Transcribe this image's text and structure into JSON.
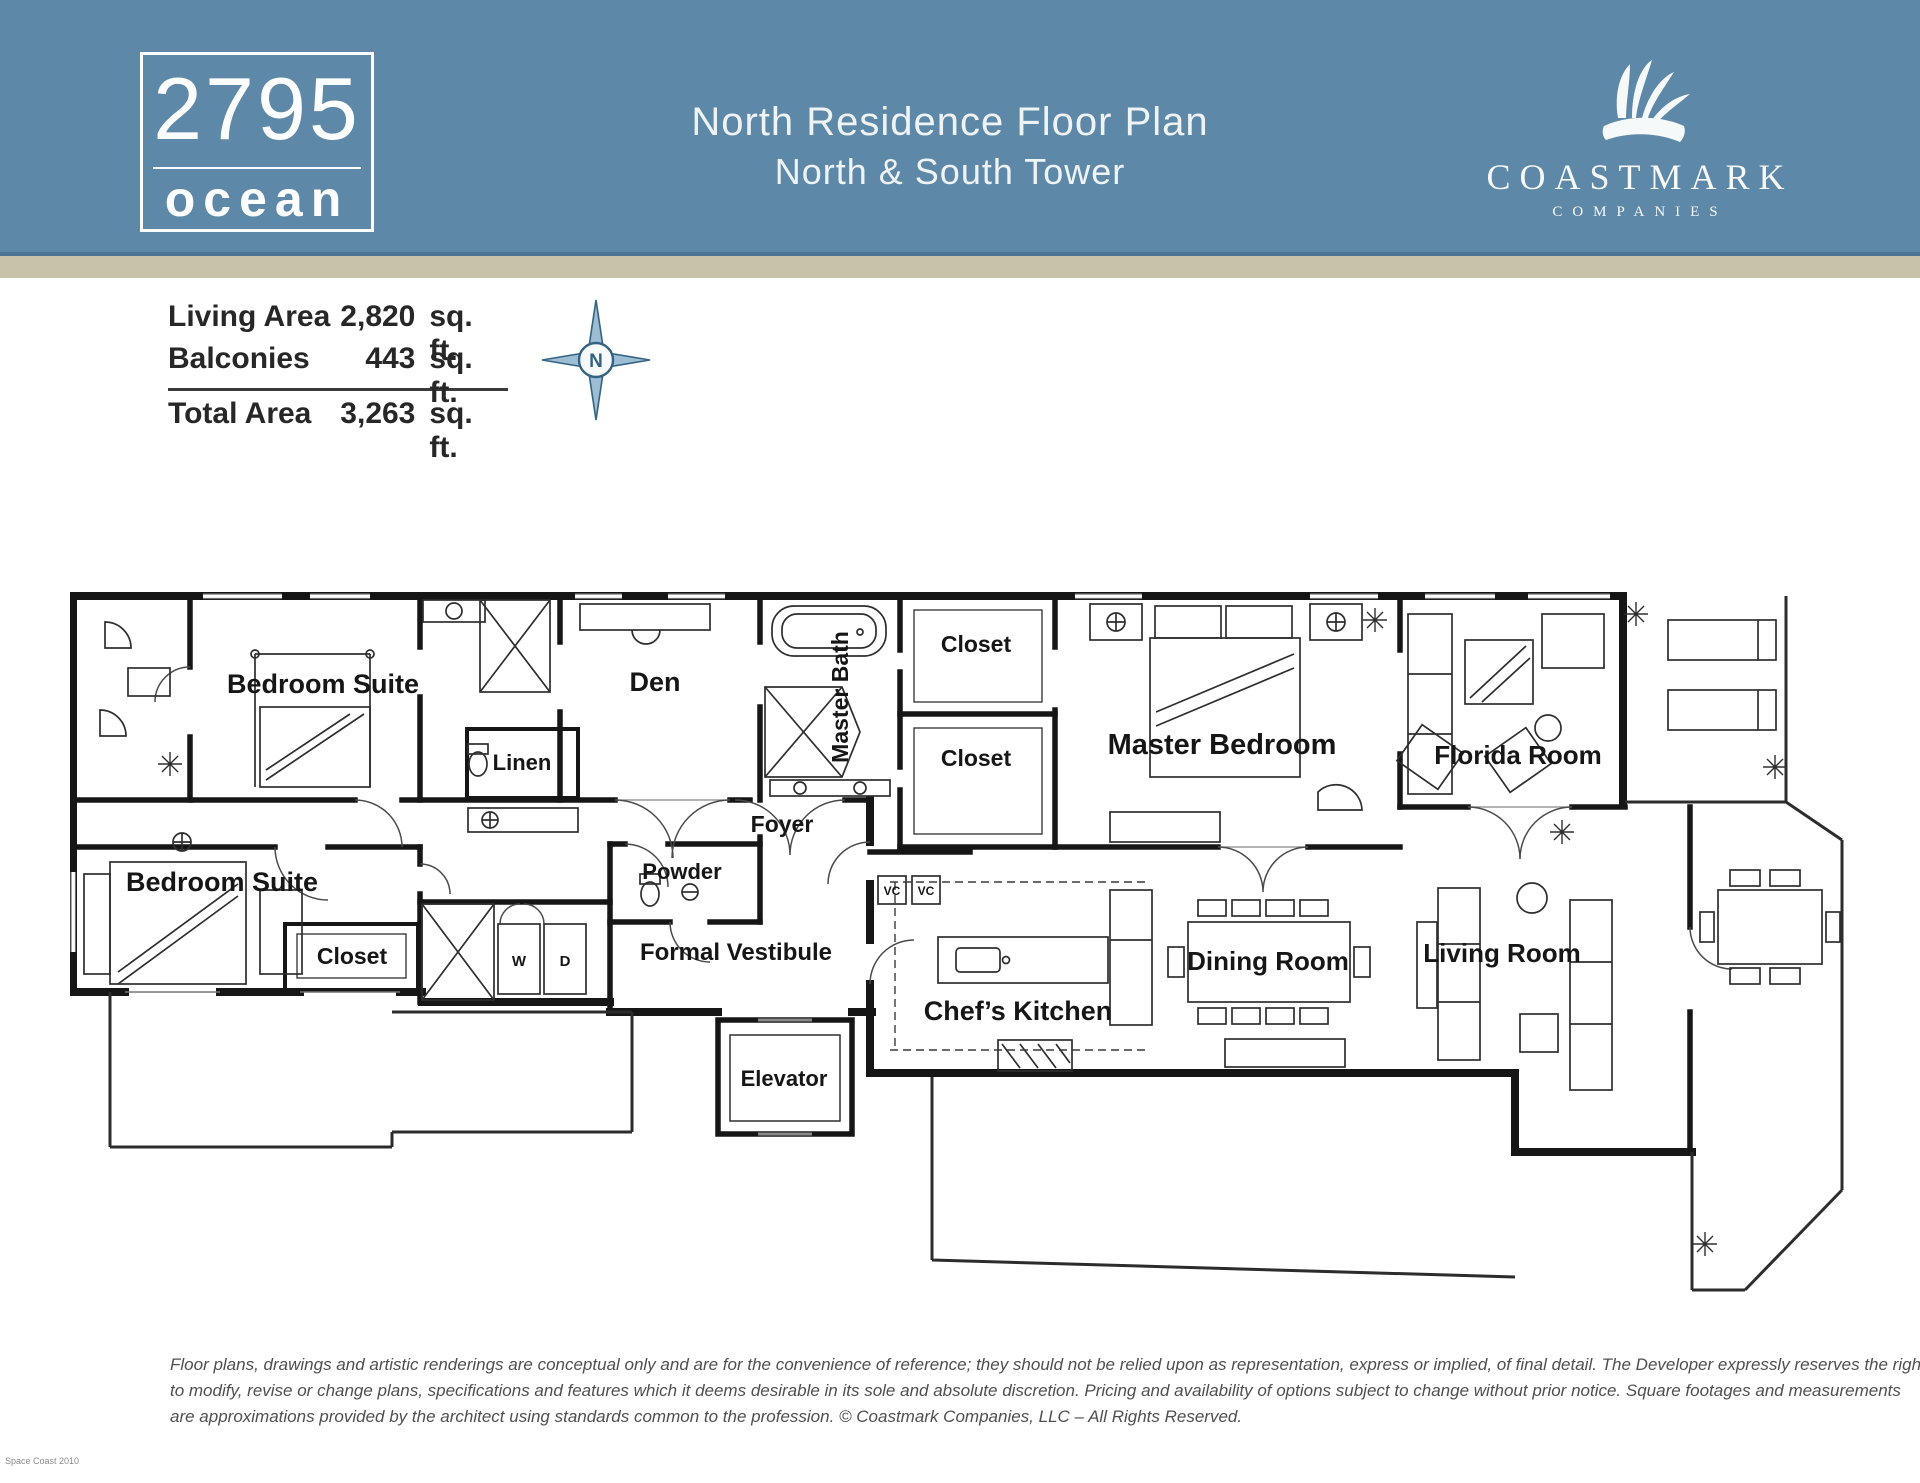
{
  "header": {
    "logo": {
      "number": "2795",
      "word": "ocean"
    },
    "title_line1": "North Residence Floor Plan",
    "title_line2": "North & South Tower",
    "brand": {
      "name": "COASTMARK",
      "subtitle": "COMPANIES"
    }
  },
  "area_summary": {
    "rows": [
      {
        "label": "Living Area",
        "value": "2,820",
        "unit": "sq. ft."
      },
      {
        "label": "Balconies",
        "value": "443",
        "unit": "sq. ft."
      },
      {
        "label": "Total Area",
        "value": "3,263",
        "unit": "sq. ft."
      }
    ]
  },
  "compass": {
    "label": "N"
  },
  "floorplan": {
    "labels": [
      {
        "text": "Bedroom Suite",
        "x": 253,
        "y": 101,
        "size": 27
      },
      {
        "text": "Den",
        "x": 585,
        "y": 99,
        "size": 27
      },
      {
        "text": "Master Bath",
        "x": 778,
        "y": 105,
        "size": 23,
        "rotate": -90
      },
      {
        "text": "Closet",
        "x": 906,
        "y": 60,
        "size": 23
      },
      {
        "text": "Closet",
        "x": 906,
        "y": 174,
        "size": 23
      },
      {
        "text": "Master Bedroom",
        "x": 1152,
        "y": 162,
        "size": 29
      },
      {
        "text": "Florida Room",
        "x": 1448,
        "y": 172,
        "size": 26
      },
      {
        "text": "Linen",
        "x": 452,
        "y": 178,
        "size": 22
      },
      {
        "text": "Foyer",
        "x": 712,
        "y": 240,
        "size": 23
      },
      {
        "text": "Bedroom Suite",
        "x": 152,
        "y": 299,
        "size": 27
      },
      {
        "text": "Closet",
        "x": 282,
        "y": 372,
        "size": 23
      },
      {
        "text": "W",
        "x": 449,
        "y": 374,
        "size": 15
      },
      {
        "text": "D",
        "x": 495,
        "y": 374,
        "size": 15
      },
      {
        "text": "Powder",
        "x": 612,
        "y": 287,
        "size": 22
      },
      {
        "text": "Formal Vestibule",
        "x": 666,
        "y": 368,
        "size": 24
      },
      {
        "text": "Elevator",
        "x": 714,
        "y": 494,
        "size": 22
      },
      {
        "text": "Chef’s Kitchen",
        "x": 948,
        "y": 428,
        "size": 27
      },
      {
        "text": "Dining Room",
        "x": 1198,
        "y": 378,
        "size": 26
      },
      {
        "text": "Living Room",
        "x": 1432,
        "y": 370,
        "size": 26
      },
      {
        "text": "VC",
        "x": 822,
        "y": 303,
        "size": 12
      },
      {
        "text": "VC",
        "x": 856,
        "y": 303,
        "size": 12
      }
    ]
  },
  "disclaimer": {
    "line1": "Floor plans, drawings and artistic renderings are conceptual only and are for the convenience of reference; they should not be relied upon as representation, express or implied, of final detail. The Developer expressly reserves the right",
    "line2": "to modify, revise or change plans, specifications and features which it deems desirable in its sole and absolute discretion. Pricing and availability of options subject to change without prior notice. Square footages and measurements",
    "line3": "are approximations provided by the architect using standards common to the profession. © Coastmark Companies, LLC – All Rights Reserved."
  },
  "corner_note": "Space Coast 2010"
}
